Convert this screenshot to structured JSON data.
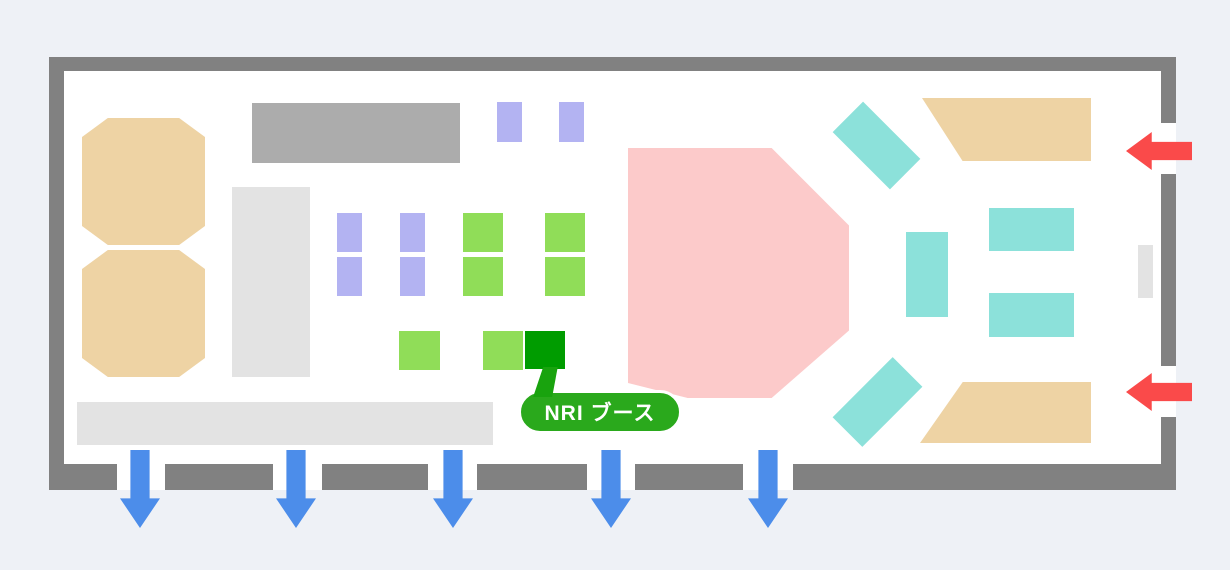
{
  "canvas": {
    "w": 1230,
    "h": 570,
    "background": "#eef1f6"
  },
  "hall": {
    "wall_color": "#818181",
    "floor": {
      "x": 49,
      "y": 57,
      "w": 1127,
      "h": 433,
      "color": "#ffffff"
    },
    "top_wall": {
      "x": 49,
      "y": 57,
      "w": 1127,
      "h": 14
    },
    "left_wall": {
      "x": 49,
      "y": 57,
      "w": 15,
      "h": 433
    },
    "right_wall": {
      "x": 1161,
      "w": 15,
      "segments": [
        {
          "y": 57,
          "h": 66
        },
        {
          "y": 174,
          "h": 192
        },
        {
          "y": 417,
          "h": 73
        }
      ]
    },
    "bottom_wall": {
      "y": 464,
      "h": 26,
      "segments": [
        {
          "x": 49,
          "w": 68
        },
        {
          "x": 165,
          "w": 108
        },
        {
          "x": 322,
          "w": 106
        },
        {
          "x": 477,
          "w": 110
        },
        {
          "x": 635,
          "w": 108
        },
        {
          "x": 793,
          "w": 383
        }
      ]
    }
  },
  "clip_paths": {
    "octagon": "polygon(21% 0%, 79% 0%, 100% 15%, 100% 85%, 79% 100%, 21% 100%, 0% 85%, 0% 15%)",
    "pink": "polygon(0% 0%, 65% 0%, 100% 31%, 100% 73%, 65% 100%, 27% 100%, 0% 94%)",
    "trap_top": "polygon(0% 0%, 100% 0%, 100% 100%, 24% 100%)",
    "trap_bottom": "polygon(25% 0%, 100% 0%, 100% 100%, 0% 100%)",
    "tail": "polygon(40% 0%, 92% 0%, 72% 100%, 4% 100%)",
    "arrow_down": "polygon(26% 0%, 74% 0%, 74% 62%, 100% 62%, 50% 100%, 0% 62%, 26% 62%)",
    "arrow_left": "polygon(100% 26%, 39% 26%, 39% 0%, 0% 50%, 39% 100%, 39% 74%, 100% 74%)"
  },
  "booths": [
    {
      "name": "tan-booth-octagon-1",
      "x": 82,
      "y": 118,
      "w": 123,
      "h": 127,
      "color": "#eed3a4",
      "shape": "octagon"
    },
    {
      "name": "tan-booth-octagon-2",
      "x": 82,
      "y": 250,
      "w": 123,
      "h": 127,
      "color": "#eed3a4",
      "shape": "octagon"
    },
    {
      "name": "gray-booth-block",
      "x": 252,
      "y": 103,
      "w": 208,
      "h": 60,
      "color": "#acacac"
    },
    {
      "name": "lightgray-zone-vertical",
      "x": 232,
      "y": 187,
      "w": 78,
      "h": 190,
      "color": "#e3e3e3"
    },
    {
      "name": "purple-booth-top-1",
      "x": 497,
      "y": 102,
      "w": 25,
      "h": 40,
      "color": "#b3b3f2"
    },
    {
      "name": "purple-booth-top-2",
      "x": 559,
      "y": 102,
      "w": 25,
      "h": 40,
      "color": "#b3b3f2"
    },
    {
      "name": "purple-booth-row1-col1",
      "x": 337,
      "y": 213,
      "w": 25,
      "h": 39,
      "color": "#b3b3f2"
    },
    {
      "name": "purple-booth-row2-col1",
      "x": 337,
      "y": 257,
      "w": 25,
      "h": 39,
      "color": "#b3b3f2"
    },
    {
      "name": "purple-booth-row1-col2",
      "x": 400,
      "y": 213,
      "w": 25,
      "h": 39,
      "color": "#b3b3f2"
    },
    {
      "name": "purple-booth-row2-col2",
      "x": 400,
      "y": 257,
      "w": 25,
      "h": 39,
      "color": "#b3b3f2"
    },
    {
      "name": "green-booth-row1-col1",
      "x": 463,
      "y": 213,
      "w": 40,
      "h": 39,
      "color": "#90dd58"
    },
    {
      "name": "green-booth-row2-col1",
      "x": 463,
      "y": 257,
      "w": 40,
      "h": 39,
      "color": "#90dd58"
    },
    {
      "name": "green-booth-row1-col2",
      "x": 545,
      "y": 213,
      "w": 40,
      "h": 39,
      "color": "#90dd58"
    },
    {
      "name": "green-booth-row2-col2",
      "x": 545,
      "y": 257,
      "w": 40,
      "h": 39,
      "color": "#90dd58"
    },
    {
      "name": "green-booth-small-1",
      "x": 399,
      "y": 331,
      "w": 41,
      "h": 39,
      "color": "#90dd58"
    },
    {
      "name": "green-booth-small-2",
      "x": 483,
      "y": 331,
      "w": 40,
      "h": 39,
      "color": "#90dd58"
    },
    {
      "name": "nri-booth",
      "x": 525,
      "y": 331,
      "w": 40,
      "h": 38,
      "color": "#009c00"
    },
    {
      "name": "pink-stage-area",
      "x": 628,
      "y": 148,
      "w": 221,
      "h": 250,
      "color": "#fccaca",
      "shape": "pink"
    },
    {
      "name": "teal-booth-diagonal-top",
      "x": 836,
      "y": 124,
      "w": 81,
      "h": 43,
      "color": "#8ce1da",
      "rotate": 45
    },
    {
      "name": "teal-booth-diagonal-bottom",
      "x": 835,
      "y": 381,
      "w": 85,
      "h": 42,
      "color": "#8ce1da",
      "rotate": -45
    },
    {
      "name": "teal-booth-vertical",
      "x": 906,
      "y": 232,
      "w": 42,
      "h": 85,
      "color": "#8ce1da"
    },
    {
      "name": "teal-booth-horizontal-1",
      "x": 989,
      "y": 208,
      "w": 85,
      "h": 43,
      "color": "#8ce1da"
    },
    {
      "name": "teal-booth-horizontal-2",
      "x": 989,
      "y": 293,
      "w": 85,
      "h": 44,
      "color": "#8ce1da"
    },
    {
      "name": "tan-booth-trapezoid-top",
      "x": 922,
      "y": 98,
      "w": 169,
      "h": 63,
      "color": "#eed3a4",
      "shape": "trap_top"
    },
    {
      "name": "tan-booth-trapezoid-bottom",
      "x": 920,
      "y": 382,
      "w": 171,
      "h": 61,
      "color": "#eed3a4",
      "shape": "trap_bottom"
    },
    {
      "name": "lightgray-pillar",
      "x": 1138,
      "y": 245,
      "w": 15,
      "h": 53,
      "color": "#e3e3e3"
    },
    {
      "name": "lightgray-zone-bottom",
      "x": 77,
      "y": 402,
      "w": 416,
      "h": 43,
      "color": "#e3e3e3"
    }
  ],
  "exit_arrows": {
    "color": "#4c8dea",
    "y": 450,
    "w": 40,
    "h": 78,
    "x_centers": [
      140,
      296,
      453,
      611,
      768
    ]
  },
  "entrance_arrows": {
    "color": "#fa4a4a",
    "tail_x": 1192,
    "w": 66,
    "h": 38,
    "y_centers": [
      151,
      392
    ]
  },
  "callout": {
    "text": "NRI ブース",
    "pill": {
      "x": 518,
      "y": 390,
      "w": 164,
      "h": 44,
      "bg": "#2aa91c",
      "border_color": "#ffffff",
      "text_color": "#ffffff",
      "font_size": 21
    },
    "tail": {
      "x": 532,
      "y": 367,
      "w": 28,
      "h": 30,
      "bg": "#19a30e"
    }
  }
}
